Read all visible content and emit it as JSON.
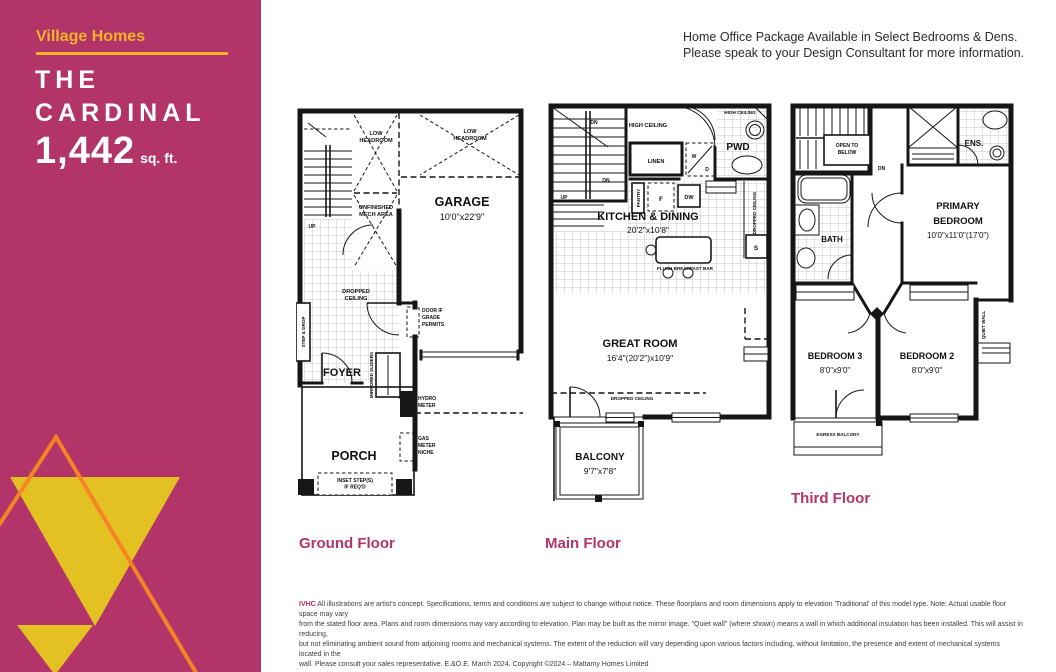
{
  "sidebar": {
    "brand": "Village Homes",
    "title_line1": "THE",
    "title_line2": "CARDINAL",
    "area_value": "1,442",
    "area_unit": "sq. ft."
  },
  "header": {
    "note_line1": "Home Office Package Available in Select Bedrooms & Dens.",
    "note_line2": "Please speak to your Design Consultant for more information."
  },
  "ground": {
    "label": "Ground Floor",
    "low_headroom_1": "LOW\nHEADROOM",
    "low_headroom_2": "LOW\nHEADROOM",
    "garage": "GARAGE",
    "garage_dims": "10'0\"x22'9\"",
    "unfinished_mech": "UNFINISHED\nMECH AREA",
    "up": "UP",
    "dropped_ceiling": "DROPPED\nCEILING",
    "step_drop": "STEP & DROP",
    "foyer": "FOYER",
    "mirrored_sliders": "MIRRORED SLIDERS",
    "door_if_grade": "DOOR IF\nGRADE\nPERMITS",
    "hydro_meter": "HYDRO\nMETER",
    "gas_meter": "GAS\nMETER\nNICHE",
    "porch": "PORCH",
    "inset_steps": "INSET STEP(S)\nIF REQ'D"
  },
  "main": {
    "label": "Main Floor",
    "dn1": "DN",
    "dn2": "DN",
    "up": "UP",
    "high_ceiling_1": "HIGH CEILING",
    "high_ceiling_2": "HIGH CEILING",
    "pwd": "PWD",
    "linen": "LINEN",
    "washer": "W",
    "dryer": "D",
    "pantry": "PANTRY",
    "fridge": "F",
    "dishwasher": "DW",
    "kitchen": "KITCHEN & DINING",
    "kitchen_dims": "20'2\"x10'8\"",
    "flush_bar": "FLUSH BREAKFAST BAR",
    "dropped_ceiling_side": "DROPPED CEILING",
    "shelf": "S",
    "great_room": "GREAT ROOM",
    "great_room_dims": "16'4\"(20'2\")x10'9\"",
    "dropped_ceiling": "DROPPED CEILING",
    "balcony": "BALCONY",
    "balcony_dims": "9'7\"x7'8\""
  },
  "third": {
    "label": "Third Floor",
    "open_to_below": "OPEN TO\nBELOW",
    "dn": "DN",
    "ensuite": "ENS.",
    "bath": "BATH",
    "primary_line1": "PRIMARY",
    "primary_line2": "BEDROOM",
    "primary_dims": "10'0\"x11'0\"(17'0\")",
    "bedroom3": "BEDROOM 3",
    "bedroom3_dims": "8'0\"x9'0\"",
    "bedroom2": "BEDROOM 2",
    "bedroom2_dims": "8'0\"x9'0\"",
    "quiet_wall": "QUIET WALL",
    "egress_balcony": "EGRESS BALCONY"
  },
  "disclaimer": {
    "prefix": "IVHC",
    "lines": [
      "All illustrations are artist's concept. Specifications, terms and conditions are subject to change without notice. These floorplans and room dimensions apply to elevation 'Traditional' of this model type. Note: Actual usable floor space may vary",
      "from the stated floor area. Plans and room dimensions may vary according to elevation. Plan may be built as the mirror image. \"Quiet wall\" (where shown) means a wall in which additional insulation has been installed. This will assist in reducing,",
      "but not eliminating ambient sound from adjoining rooms and mechanical systems. The extent of the reduction will vary depending upon various factors including, without limitation, the presence and extent of mechanical systems located in the",
      "wall. Please consult your sales representative. E.&O.E. March 2024. Copyright ©2024 – Mattamy Homes Limited"
    ]
  },
  "colors": {
    "magenta": "#B23468",
    "accent_yellow": "#F2B229",
    "triangle_yellow": "#E3C122",
    "triangle_orange": "#F58426",
    "plan_ink": "#161616"
  }
}
